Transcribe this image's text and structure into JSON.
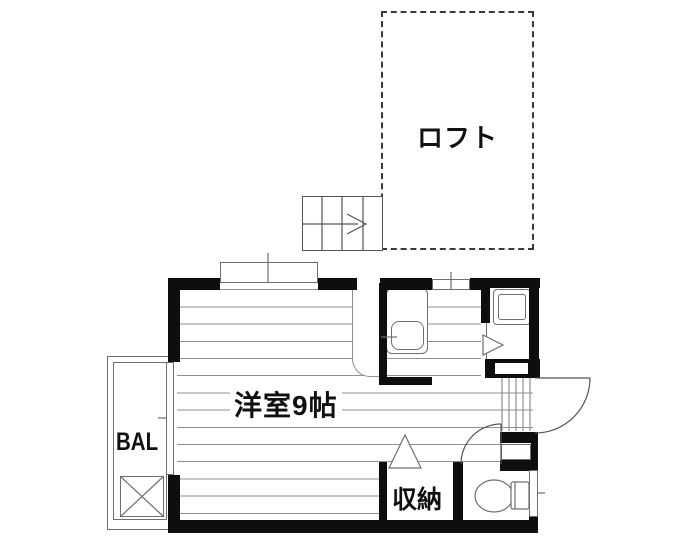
{
  "labels": {
    "loft": "ロフト",
    "main_room": "洋室9帖",
    "balcony": "BAL",
    "storage": "収納"
  },
  "colors": {
    "wall": "#0e0e0e",
    "floor": "#909090",
    "fixture": "#6f6f6f",
    "door": "#555555",
    "dash": "#3a3a3a",
    "text": "#101010"
  }
}
